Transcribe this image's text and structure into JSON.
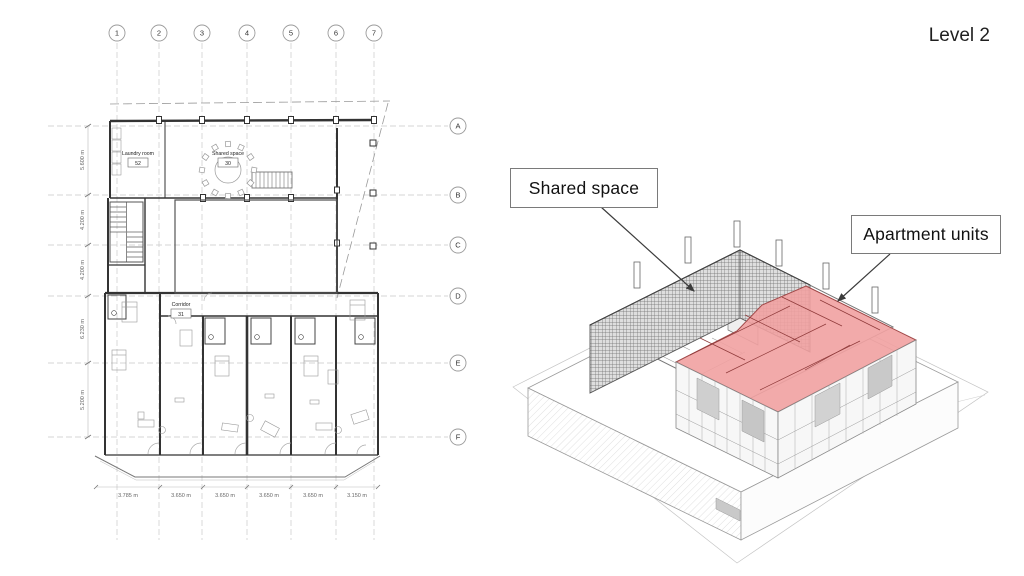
{
  "slide": {
    "title": "Level 2"
  },
  "floor_plan": {
    "grid_columns": [
      "1",
      "2",
      "3",
      "4",
      "5",
      "6",
      "7"
    ],
    "grid_rows": [
      "A",
      "B",
      "C",
      "D",
      "E",
      "F"
    ],
    "rooms": [
      {
        "name": "Laundry room",
        "number": "52"
      },
      {
        "name": "Shared space",
        "number": "30"
      },
      {
        "name": "Corridor",
        "number": "31"
      }
    ],
    "dimensions_left": [
      "5.600 m",
      "4.200 m",
      "4.200 m",
      "6.230 m",
      "5.200 m"
    ],
    "dimensions_bottom": [
      "3.785 m",
      "3.650 m",
      "3.650 m",
      "3.650 m",
      "3.650 m",
      "3.150 m"
    ]
  },
  "axonometric": {
    "callouts": [
      {
        "label": "Shared space"
      },
      {
        "label": "Apartment units"
      }
    ],
    "highlight": {
      "label": "apartment-units-highlight",
      "color": "#f1a1a1"
    }
  },
  "colors": {
    "highlight_red": "#f1a1a1",
    "highlight_red_line": "#a04848",
    "callout_border": "#7a7a7a",
    "drawing_line": "#333333"
  }
}
